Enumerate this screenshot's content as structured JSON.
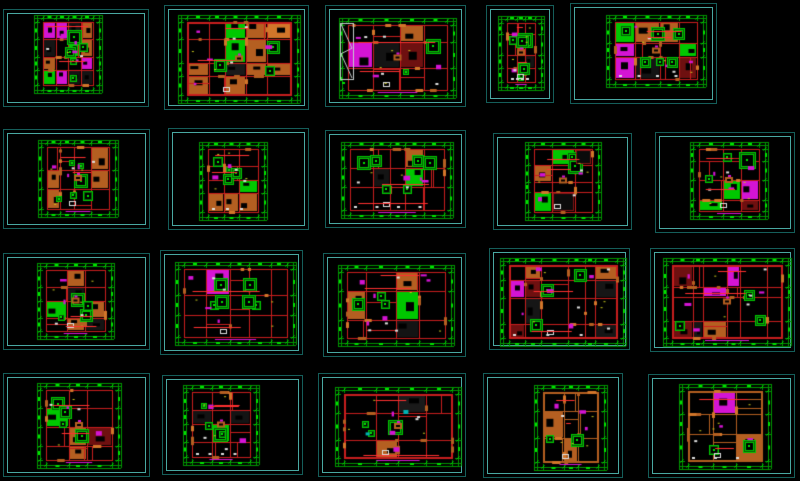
{
  "sheet": {
    "width": 800,
    "height": 481,
    "background": "#000000"
  },
  "grid": {
    "rows": 4,
    "cols": 5,
    "total_plans": 20
  },
  "palette": {
    "background": "#000000",
    "frame_border_outer": "#155e5a",
    "frame_border_inner": "#49a8a2",
    "dim_green": "#009600",
    "text_green": "#00e400",
    "wall_red": "#c81e1e",
    "bright_red": "#ff3030",
    "wall_orange": "#b45f21",
    "light_orange": "#d2762a",
    "furniture_green": "#00c800",
    "magenta": "#d414d4",
    "white": "#dedede",
    "yellow": "#c8c81e",
    "cyan": "#00b4b4",
    "stair_grey": "#c4cccc",
    "dark_fill": "#0b0b0b"
  },
  "frames": [
    {
      "id": "r1c1",
      "row": 1,
      "col": 1,
      "x": 3,
      "y": 9,
      "w": 146,
      "h": 98,
      "plan": {
        "x": 30,
        "y": 5,
        "w": 68,
        "h": 78
      },
      "seed": 11,
      "style": "mosaic"
    },
    {
      "id": "r1c2",
      "row": 1,
      "col": 2,
      "x": 164,
      "y": 5,
      "w": 145,
      "h": 105,
      "plan": {
        "x": 13,
        "y": 9,
        "w": 122,
        "h": 88
      },
      "seed": 22,
      "style": "orange-dense"
    },
    {
      "id": "r1c3",
      "row": 1,
      "col": 3,
      "x": 325,
      "y": 5,
      "w": 141,
      "h": 102,
      "plan": {
        "x": 13,
        "y": 12,
        "w": 117,
        "h": 80
      },
      "seed": 33,
      "style": "stairs"
    },
    {
      "id": "r1c4",
      "row": 1,
      "col": 4,
      "x": 486,
      "y": 5,
      "w": 68,
      "h": 98,
      "plan": {
        "x": 11,
        "y": 10,
        "w": 46,
        "h": 74
      },
      "seed": 44,
      "style": "small-green"
    },
    {
      "id": "r1c5",
      "row": 1,
      "col": 5,
      "x": 570,
      "y": 3,
      "w": 147,
      "h": 101,
      "plan": {
        "x": 35,
        "y": 11,
        "w": 100,
        "h": 72
      },
      "seed": 55,
      "style": "green-rooms"
    },
    {
      "id": "r2c1",
      "row": 2,
      "col": 1,
      "x": 3,
      "y": 129,
      "w": 147,
      "h": 100,
      "plan": {
        "x": 34,
        "y": 10,
        "w": 80,
        "h": 77
      },
      "seed": 66,
      "style": "green-rooms"
    },
    {
      "id": "r2c2",
      "row": 2,
      "col": 2,
      "x": 168,
      "y": 128,
      "w": 141,
      "h": 102,
      "plan": {
        "x": 30,
        "y": 13,
        "w": 68,
        "h": 78
      },
      "seed": 77,
      "style": "compact"
    },
    {
      "id": "r2c3",
      "row": 2,
      "col": 3,
      "x": 325,
      "y": 130,
      "w": 141,
      "h": 98,
      "plan": {
        "x": 15,
        "y": 11,
        "w": 112,
        "h": 76
      },
      "seed": 88,
      "style": "symmetric-green"
    },
    {
      "id": "r2c4",
      "row": 2,
      "col": 4,
      "x": 493,
      "y": 133,
      "w": 139,
      "h": 97,
      "plan": {
        "x": 31,
        "y": 8,
        "w": 76,
        "h": 78
      },
      "seed": 99,
      "style": "dark-rooms"
    },
    {
      "id": "r2c5",
      "row": 2,
      "col": 5,
      "x": 655,
      "y": 132,
      "w": 140,
      "h": 101,
      "plan": {
        "x": 34,
        "y": 9,
        "w": 78,
        "h": 77
      },
      "seed": 111,
      "style": "big-green"
    },
    {
      "id": "r3c1",
      "row": 3,
      "col": 1,
      "x": 3,
      "y": 253,
      "w": 147,
      "h": 97,
      "plan": {
        "x": 33,
        "y": 9,
        "w": 77,
        "h": 76
      },
      "seed": 122,
      "style": "compact"
    },
    {
      "id": "r3c2",
      "row": 3,
      "col": 2,
      "x": 160,
      "y": 250,
      "w": 143,
      "h": 105,
      "plan": {
        "x": 14,
        "y": 11,
        "w": 121,
        "h": 83
      },
      "seed": 133,
      "style": "symmetric-green"
    },
    {
      "id": "r3c3",
      "row": 3,
      "col": 3,
      "x": 323,
      "y": 253,
      "w": 143,
      "h": 104,
      "plan": {
        "x": 14,
        "y": 11,
        "w": 116,
        "h": 81
      },
      "seed": 144,
      "style": "magenta-units"
    },
    {
      "id": "r3c4",
      "row": 3,
      "col": 4,
      "x": 489,
      "y": 248,
      "w": 141,
      "h": 102,
      "plan": {
        "x": 10,
        "y": 9,
        "w": 126,
        "h": 88
      },
      "seed": 155,
      "style": "red-dense"
    },
    {
      "id": "r3c5",
      "row": 3,
      "col": 5,
      "x": 650,
      "y": 248,
      "w": 145,
      "h": 104,
      "plan": {
        "x": 12,
        "y": 9,
        "w": 128,
        "h": 88
      },
      "seed": 166,
      "style": "red-dense"
    },
    {
      "id": "r4c1",
      "row": 4,
      "col": 1,
      "x": 3,
      "y": 373,
      "w": 147,
      "h": 104,
      "plan": {
        "x": 33,
        "y": 9,
        "w": 84,
        "h": 85
      },
      "seed": 177,
      "style": "compact"
    },
    {
      "id": "r4c2",
      "row": 4,
      "col": 2,
      "x": 162,
      "y": 375,
      "w": 141,
      "h": 100,
      "plan": {
        "x": 20,
        "y": 9,
        "w": 76,
        "h": 80
      },
      "seed": 188,
      "style": "compact"
    },
    {
      "id": "r4c3",
      "row": 4,
      "col": 3,
      "x": 318,
      "y": 373,
      "w": 148,
      "h": 104,
      "plan": {
        "x": 16,
        "y": 13,
        "w": 126,
        "h": 79
      },
      "seed": 199,
      "style": "orange-cyan"
    },
    {
      "id": "r4c4",
      "row": 4,
      "col": 4,
      "x": 483,
      "y": 373,
      "w": 140,
      "h": 105,
      "plan": {
        "x": 50,
        "y": 11,
        "w": 73,
        "h": 85
      },
      "seed": 210,
      "style": "orange-sparse"
    },
    {
      "id": "r4c5",
      "row": 4,
      "col": 5,
      "x": 648,
      "y": 374,
      "w": 147,
      "h": 104,
      "plan": {
        "x": 30,
        "y": 9,
        "w": 92,
        "h": 85
      },
      "seed": 221,
      "style": "orange-sparse"
    }
  ]
}
